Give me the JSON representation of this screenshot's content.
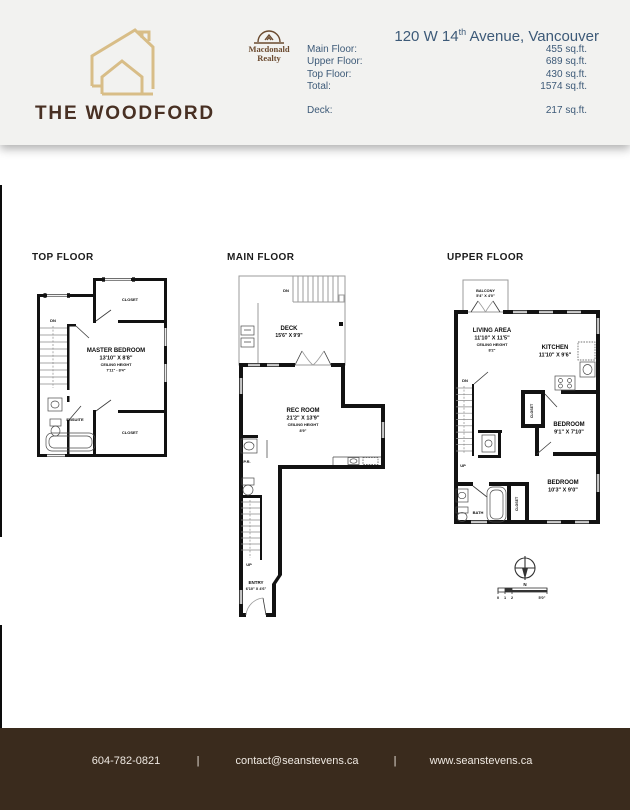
{
  "colors": {
    "header_bg": "#f2f2f0",
    "footer_bg": "#3a2b1d",
    "brand_brown": "#483023",
    "logo_tan": "#d8bd87",
    "realty_brown": "#6b4a2f",
    "header_text_blue": "#3d5a78",
    "wall_black": "#121212"
  },
  "header": {
    "brand": {
      "title": "THE WOODFORD"
    },
    "realty": {
      "line1": "Macdonald",
      "line2": "Realty"
    },
    "address": {
      "prefix": "120 W 14",
      "superscript": "th",
      "suffix": " Avenue, Vancouver"
    },
    "stats": {
      "rows": [
        {
          "label": "Main Floor:",
          "value": "455 sq.ft."
        },
        {
          "label": "Upper Floor:",
          "value": "689 sq.ft."
        },
        {
          "label": "Top Floor:",
          "value": "430 sq.ft."
        },
        {
          "label": "Total:",
          "value": "1574 sq.ft."
        }
      ],
      "deck_row": {
        "label": "Deck:",
        "value": "217 sq.ft."
      }
    }
  },
  "plans": {
    "top_floor": {
      "title": "TOP FLOOR",
      "closet_top": "CLOSET",
      "dn": "DN",
      "room": "MASTER BEDROOM",
      "room_dims": "13'10\" X 8'8\"",
      "ceiling_label": "CEILING HEIGHT",
      "ceiling_value": "7'11\" - 8'4\"",
      "ensuite": "ENSUITE",
      "closet_bottom": "CLOSET"
    },
    "main_floor": {
      "title": "MAIN FLOOR",
      "dn": "DN",
      "deck": "DECK",
      "deck_dims": "15'6\" X 9'9\"",
      "rec_room": "REC ROOM",
      "rec_dims": "21'2\" X 13'9\"",
      "ceiling_label": "CEILING HEIGHT",
      "ceiling_value": "8'9\"",
      "pr": "P.R.",
      "up": "UP",
      "entry": "ENTRY",
      "entry_dims": "6'10\" X 4'6\""
    },
    "upper_floor": {
      "title": "UPPER FLOOR",
      "balcony": "BALCONY",
      "balcony_dims": "5'4\" X 4'0\"",
      "living": "LIVING AREA",
      "living_dims": "11'10\" X 11'5\"",
      "ceiling_label": "CEILING HEIGHT",
      "ceiling_value": "8'2\"",
      "kitchen": "KITCHEN",
      "kitchen_dims": "11'10\" X 9'6\"",
      "dn": "DN",
      "up": "UP",
      "bedroom1": "BEDROOM",
      "bedroom1_dims": "9'1\" X 7'10\"",
      "closet1": "CLOSET",
      "bedroom2": "BEDROOM",
      "bedroom2_dims": "10'3\" X 9'0\"",
      "closet2": "CLOSET",
      "bath": "BATH"
    }
  },
  "compass": {
    "north": "N",
    "tick0": "0",
    "tick1": "1",
    "tick2": "2",
    "scale_end": "5'0\""
  },
  "footer": {
    "phone": "604-782-0821",
    "separator": "|",
    "email": "contact@seanstevens.ca",
    "website": "www.seanstevens.ca"
  }
}
